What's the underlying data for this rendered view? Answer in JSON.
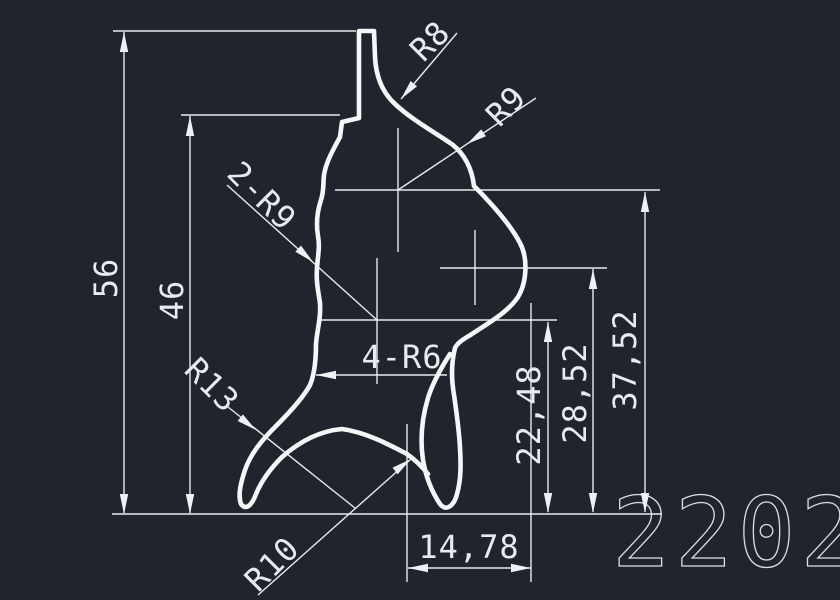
{
  "drawing": {
    "part_number": "2202",
    "colors": {
      "background": "#20242c",
      "profile_line": "#f4f6f8",
      "dimension_line": "#e7ebf0"
    },
    "linear_dimensions": {
      "overall_height": "56",
      "upper_height": "46",
      "height_a": "22,48",
      "height_b": "28,52",
      "height_c": "37,52",
      "bottom_width": "14,78"
    },
    "radius_labels": {
      "top_fillet": "R8",
      "upper_right": "R9",
      "left_double": "2-R9",
      "middle_quad": "4-R6",
      "lower_left": "R13",
      "bottom_arch": "R10"
    }
  }
}
